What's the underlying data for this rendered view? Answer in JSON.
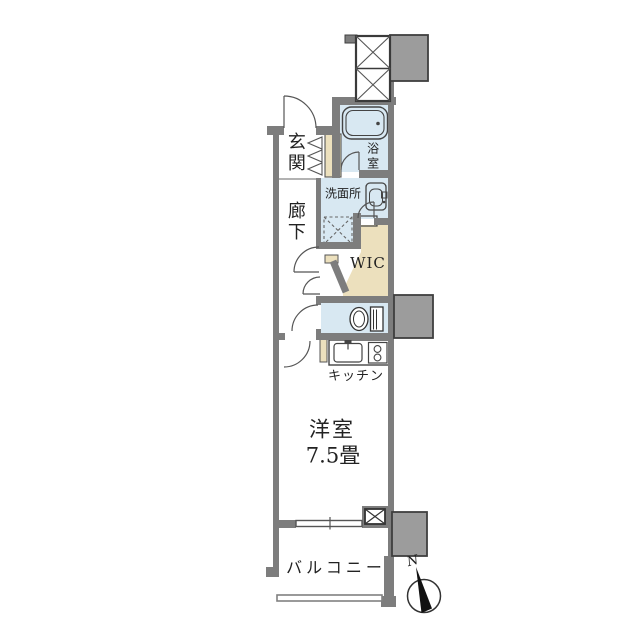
{
  "floorplan": {
    "labels": {
      "entrance": "玄関",
      "hallway": "廊下",
      "bathroom": "浴室",
      "washroom": "洗面所",
      "walk_in_closet": "WIC",
      "kitchen": "キッチン",
      "western_room": "洋室",
      "western_room_size": "7.5畳",
      "balcony": "バルコニー",
      "compass_north": "N"
    },
    "colors": {
      "wall": "#7d7d7d",
      "block": "#9c9c9c",
      "wet": "#d8e8f2",
      "closet": "#ece0bd",
      "line": "#555555",
      "text": "#222222",
      "bg": "#ffffff"
    }
  }
}
